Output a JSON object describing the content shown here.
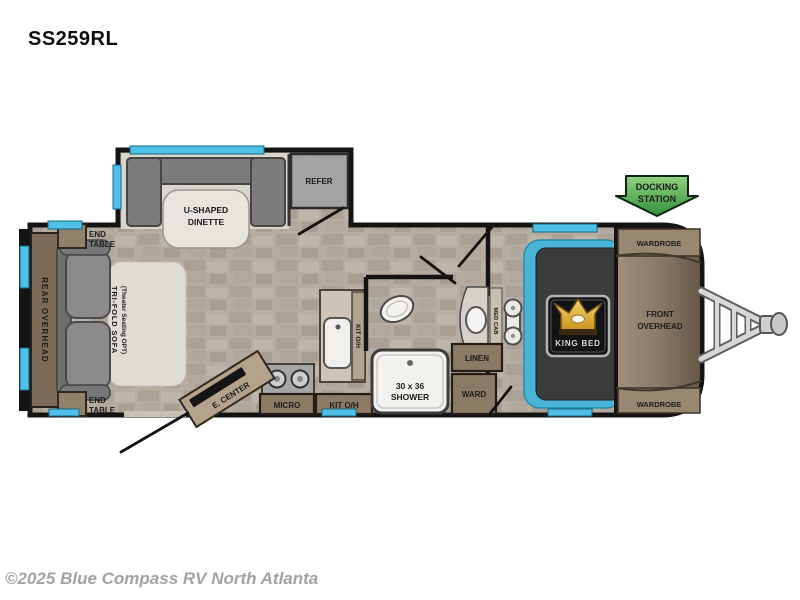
{
  "page": {
    "model": "SS259RL",
    "copyright": "©2025 Blue Compass RV North Atlanta"
  },
  "floorplan": {
    "labels": {
      "rear_overhead": "REAR OVERHEAD",
      "end_table_top": [
        "END",
        "TABLE"
      ],
      "end_table_bottom": [
        "END",
        "TABLE"
      ],
      "tri_fold_sofa": [
        "TRI-FOLD SOFA",
        "(Theater Seating OPT)"
      ],
      "u_shaped_dinette": [
        "U-SHAPED",
        "DINETTE"
      ],
      "refer": "REFER",
      "e_center": "E. CENTER",
      "micro": "MICRO",
      "kit_oh_wall": "KIT O/H",
      "kit_oh_base": "KIT O/H",
      "shower": [
        "30 x 36",
        "SHOWER"
      ],
      "med_cab": "MED CAB",
      "linen": "LINEN",
      "ward": "WARD",
      "king_bed": "KING BED",
      "front_overhead": [
        "FRONT",
        "OVERHEAD"
      ],
      "wardrobe_top": "WARDROBE",
      "wardrobe_bottom": "WARDROBE",
      "docking_station": [
        "DOCKING",
        "STATION"
      ]
    },
    "colors": {
      "wall": "#141414",
      "floor_tile": "#b6ada2",
      "slide_floor": "#d8d5cf",
      "cabinet_brown": "#8d7a64",
      "sofa_gray": "#8b8b8b",
      "window_cyan": "#4fc0e8",
      "bed_platform_cyan": "#49b4d6",
      "docking_green": "#46a94c",
      "crown_gold": "#d9a62e",
      "front_cap_brown": "#8a7a66",
      "copyright_gray": "#a2a2a2"
    }
  }
}
